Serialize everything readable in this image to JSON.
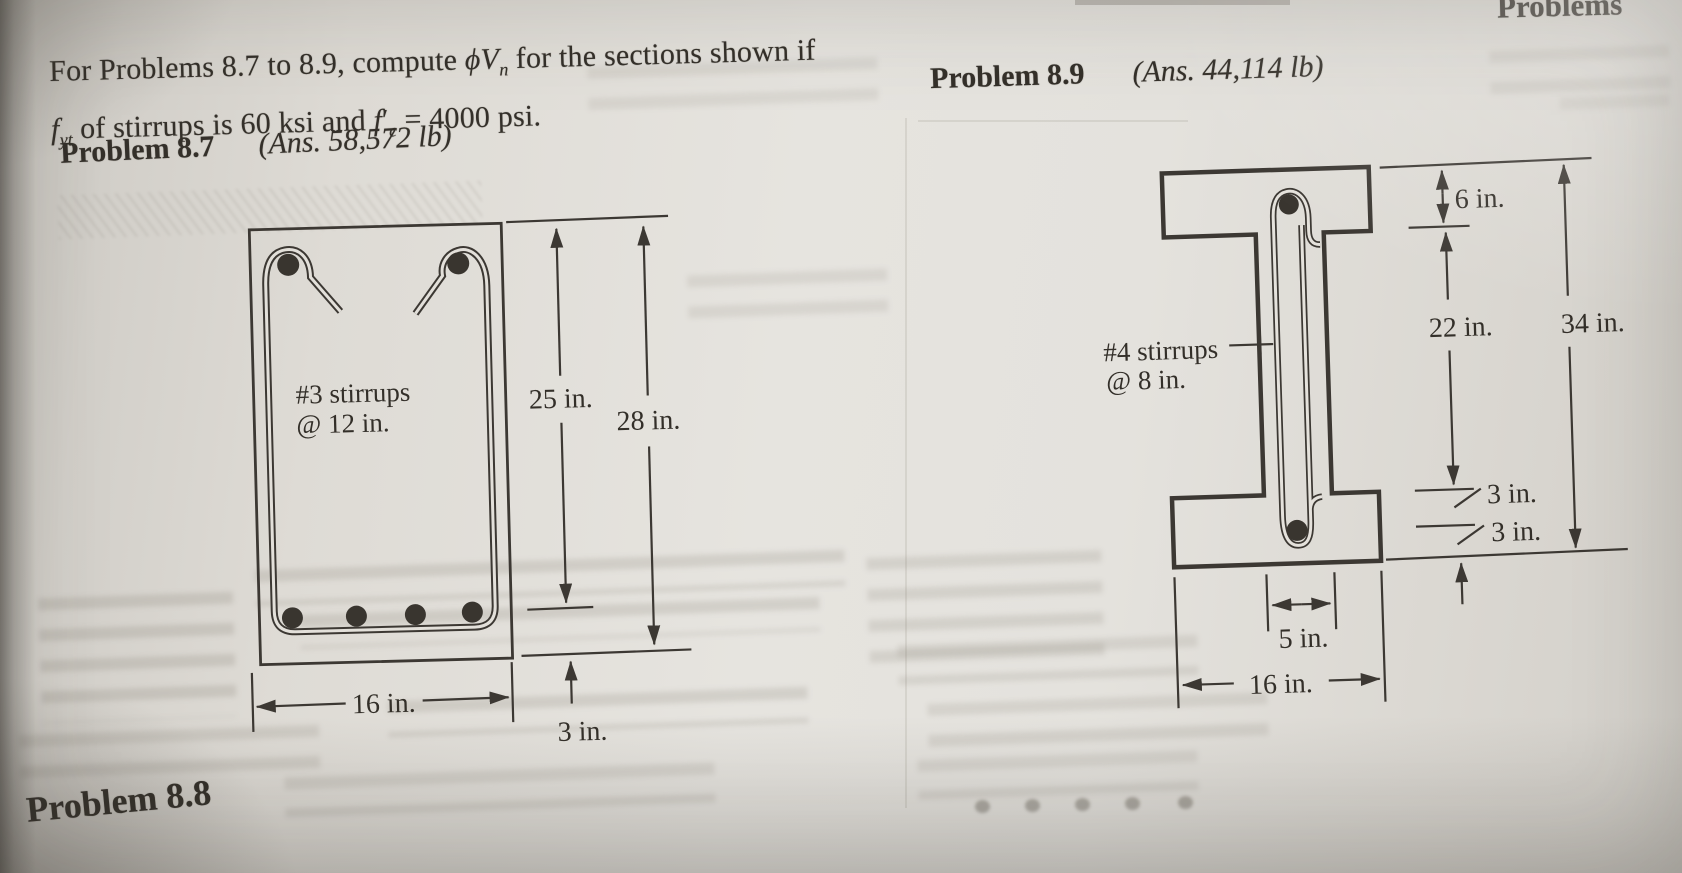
{
  "header": {
    "running_title": "Problems"
  },
  "intro": {
    "l1a": "For Problems 8.7 to 8.9, compute ",
    "phi_v": "ϕV",
    "phi_v_sub": "n",
    "l1b": " for the sections shown if",
    "f_yt": "f",
    "f_yt_sub": "yt",
    "l2a": " of stirrups is 60 ksi and ",
    "f_c": "f",
    "f_c_prime": "′",
    "f_c_sub": "c",
    "l2b": " = 4000 psi."
  },
  "problem_8_7": {
    "label": "Problem 8.7",
    "answer": "(Ans. 58,572 lb)"
  },
  "problem_8_8": {
    "label": "Problem 8.8"
  },
  "problem_8_9": {
    "label": "Problem 8.9",
    "answer": "(Ans. 44,114 lb)"
  },
  "figure_8_7": {
    "stirrups_line1": "#3 stirrups",
    "stirrups_line2": "@ 12 in.",
    "dim_depth": "25 in.",
    "dim_height": "28 in.",
    "dim_cover": "3 in.",
    "dim_width": "16 in."
  },
  "figure_8_9": {
    "stirrups_line1": "#4 stirrups",
    "stirrups_line2": "@ 8 in.",
    "dim_flange_thickness": "6 in.",
    "dim_web_depth": "22 in.",
    "dim_overall_depth": "34 in.",
    "dim_cover_upper": "3 in.",
    "dim_cover_lower": "3 in.",
    "dim_web_width": "5 in.",
    "dim_flange_width": "16 in."
  }
}
